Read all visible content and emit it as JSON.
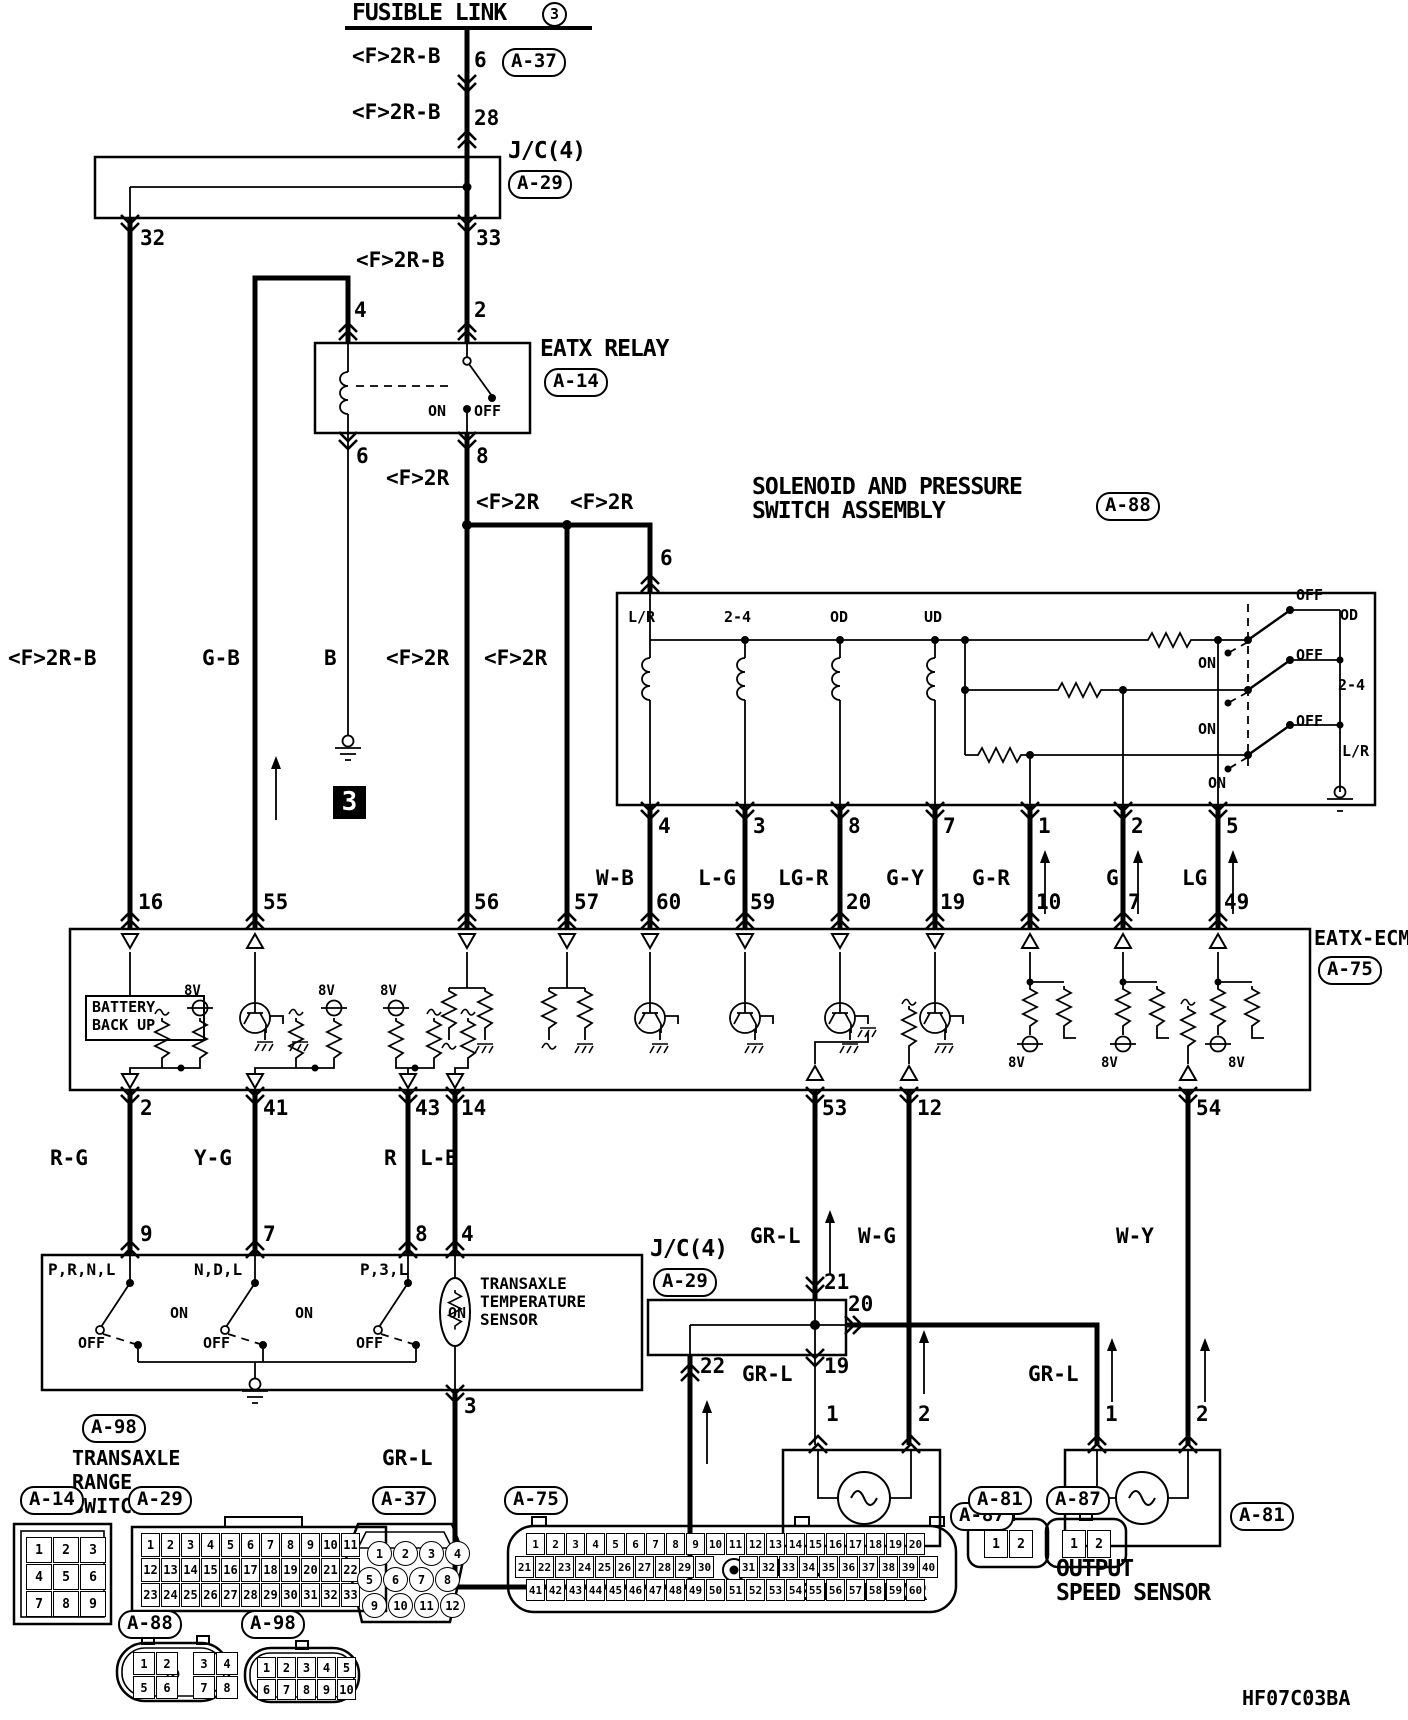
{
  "meta": {
    "code": "HF07C03BA",
    "ink": "#000000",
    "paper": "#ffffff"
  },
  "titles": {
    "fusible_link": "FUSIBLE LINK",
    "fusible_link_num": "3",
    "junction": "J/C(4)",
    "relay": "EATX RELAY",
    "solenoid_line1": "SOLENOID AND PRESSURE",
    "solenoid_line2": "SWITCH ASSEMBLY",
    "ecm": "EATX-ECM",
    "battery_line1": "BATTERY",
    "battery_line2": "BACK UP",
    "range_line1": "TRANSAXLE",
    "range_line2": "RANGE",
    "range_line3": "SWITCH",
    "temp_line1": "TRANSAXLE",
    "temp_line2": "TEMPERATURE",
    "temp_line3": "SENSOR",
    "input": "INPUT",
    "output": "OUTPUT",
    "speed": "SPEED SENSOR"
  },
  "connectors": {
    "a14": "A-14",
    "a29": "A-29",
    "a37": "A-37",
    "a75": "A-75",
    "a81": "A-81",
    "a87": "A-87",
    "a88": "A-88",
    "a98": "A-98"
  },
  "wires": {
    "f2rb": "<F>2R-B",
    "f2r": "<F>2R",
    "gb": "G-B",
    "b": "B",
    "wb": "W-B",
    "lgdash": "L-G",
    "lgr": "LG-R",
    "gy": "G-Y",
    "gr": "G-R",
    "g": "G",
    "lg": "LG",
    "rg": "R-G",
    "yg": "Y-G",
    "r": "R",
    "lb": "L-B",
    "grl": "GR-L",
    "wg": "W-G",
    "wy": "W-Y"
  },
  "sw": {
    "on": "ON",
    "off": "OFF",
    "v8": "8V",
    "prnl": "P,R,N,L",
    "ndl": "N,D,L",
    "p3l": "P,3,L",
    "sol_lr": "L/R",
    "sol_24": "2-4",
    "sol_od": "OD",
    "sol_ud": "UD"
  },
  "num": {
    "1": "1",
    "2": "2",
    "3": "3",
    "4": "4",
    "5": "5",
    "6": "6",
    "7": "7",
    "8": "8",
    "9": "9",
    "10": "10",
    "12": "12",
    "14": "14",
    "16": "16",
    "19": "19",
    "20": "20",
    "21": "21",
    "22": "22",
    "28": "28",
    "32": "32",
    "33": "33",
    "41": "41",
    "43": "43",
    "49": "49",
    "53": "53",
    "54": "54",
    "55": "55",
    "56": "56",
    "57": "57",
    "59": "59",
    "60": "60"
  },
  "pinouts": {
    "a14": [
      [
        "1",
        "2",
        "3"
      ],
      [
        "4",
        "5",
        "6"
      ],
      [
        "7",
        "8",
        "9"
      ]
    ],
    "a29": [
      [
        "1",
        "2",
        "3",
        "4",
        "5",
        "6",
        "7",
        "8",
        "9",
        "10",
        "11"
      ],
      [
        "12",
        "13",
        "14",
        "15",
        "16",
        "17",
        "18",
        "19",
        "20",
        "21",
        "22"
      ],
      [
        "23",
        "24",
        "25",
        "26",
        "27",
        "28",
        "29",
        "30",
        "31",
        "32",
        "33"
      ]
    ],
    "a37": [
      [
        "1",
        "2",
        "3",
        "4"
      ],
      [
        "5",
        "6",
        "7",
        "8"
      ],
      [
        "9",
        "10",
        "11",
        "12"
      ]
    ],
    "a75": [
      [
        "1",
        "2",
        "3",
        "4",
        "5",
        "6",
        "7",
        "8",
        "9",
        "10",
        "11",
        "12",
        "13",
        "14",
        "15",
        "16",
        "17",
        "18",
        "19",
        "20"
      ],
      [
        "21",
        "22",
        "23",
        "24",
        "25",
        "26",
        "27",
        "28",
        "29",
        "30",
        "31",
        "32",
        "33",
        "34",
        "35",
        "36",
        "37",
        "38",
        "39",
        "40"
      ],
      [
        "41",
        "42",
        "43",
        "44",
        "45",
        "46",
        "47",
        "48",
        "49",
        "50",
        "51",
        "52",
        "53",
        "54",
        "55",
        "56",
        "57",
        "58",
        "59",
        "60"
      ]
    ],
    "a81": [
      [
        "1",
        "2"
      ]
    ],
    "a87": [
      [
        "1",
        "2"
      ]
    ],
    "a88": [
      [
        "1",
        "2",
        "3",
        "4"
      ],
      [
        "5",
        "6",
        "7",
        "8"
      ]
    ],
    "a98": [
      [
        "1",
        "2",
        "3",
        "4",
        "5"
      ],
      [
        "6",
        "7",
        "8",
        "9",
        "10"
      ]
    ]
  }
}
